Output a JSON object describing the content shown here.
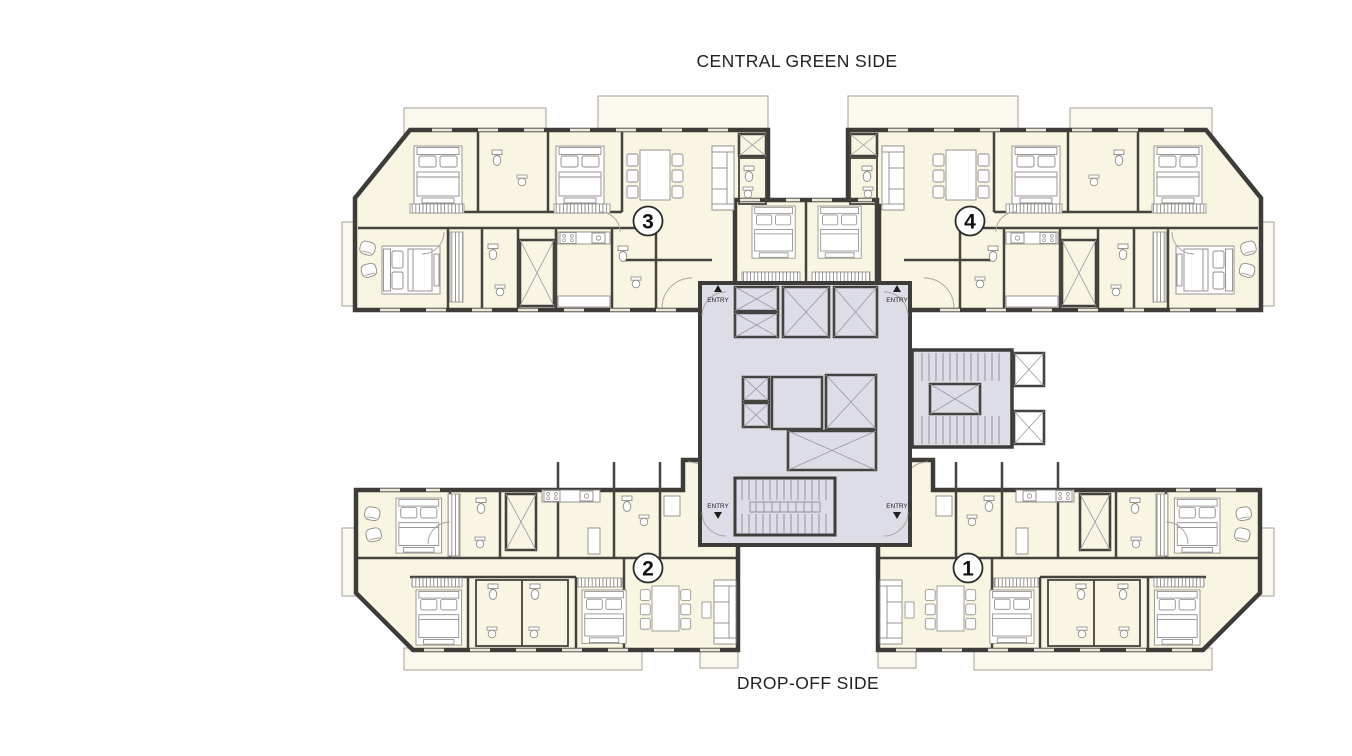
{
  "page": {
    "top_label": "CENTRAL GREEN SIDE",
    "bottom_label": "DROP-OFF SIDE"
  },
  "units": [
    {
      "number": "1",
      "position": "bottom-right"
    },
    {
      "number": "2",
      "position": "bottom-left"
    },
    {
      "number": "3",
      "position": "top-left"
    },
    {
      "number": "4",
      "position": "top-right"
    }
  ],
  "core": {
    "entry_label": "ENTRY",
    "entries": [
      {
        "side": "top-left",
        "direction": "up",
        "icon": "triangle-up-icon"
      },
      {
        "side": "top-right",
        "direction": "up",
        "icon": "triangle-up-icon"
      },
      {
        "side": "bottom-left",
        "direction": "down",
        "icon": "triangle-down-icon"
      },
      {
        "side": "bottom-right",
        "direction": "down",
        "icon": "triangle-down-icon"
      }
    ],
    "features": [
      "elevator-bank",
      "main-staircase",
      "secondary-staircase",
      "service-shafts"
    ]
  },
  "colors": {
    "background": "#ffffff",
    "unit_floor": "#f8f5e3",
    "balcony_floor": "#fbf9ee",
    "core_floor": "#dcdde6",
    "wall": "#3e3c39",
    "furniture_line": "#8d8b85",
    "text": "#231f20"
  }
}
